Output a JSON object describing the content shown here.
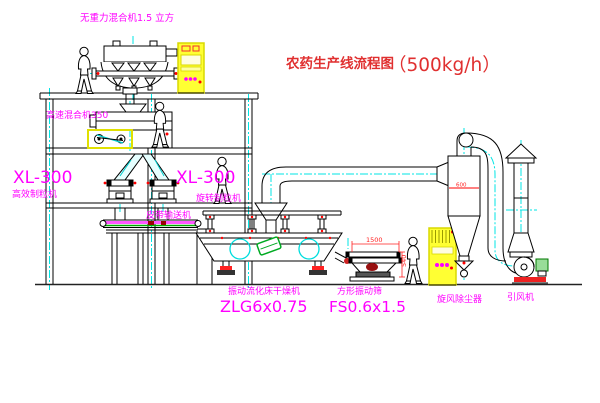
{
  "diagram": {
    "title": {
      "name": "农药生产线流程图",
      "capacity": "（500kg/h）"
    },
    "labels": {
      "gravity_mixer": "无重力混合机1.5 立方",
      "high_speed_mixer": "高速混合机350",
      "granulator_left_model": "XL-300",
      "granulator_left_name": "高效制粒机",
      "granulator_right_model": "XL-300",
      "granulator_right_name": "旋转制粒机",
      "belt_conveyor": "皮带输送机",
      "dryer_name": "振动流化床干燥机",
      "dryer_model": "ZLG6x0.75",
      "screen_name": "方形振动筛",
      "screen_model": "FS0.6x1.5",
      "cyclone": "旋风除尘器",
      "fan": "引风机"
    },
    "dimensions": {
      "screen_length": "1500",
      "screen_height": "540",
      "cyclone_marking": "600"
    },
    "colors": {
      "label_magenta": "#ff00ff",
      "title_red": "#c23333",
      "centerline_cyan": "#00ffff",
      "cabinet_yellow": "#ffff33",
      "motor_green": "#00aa22",
      "dimension_red": "#ff2020",
      "line_black": "#000000"
    }
  }
}
